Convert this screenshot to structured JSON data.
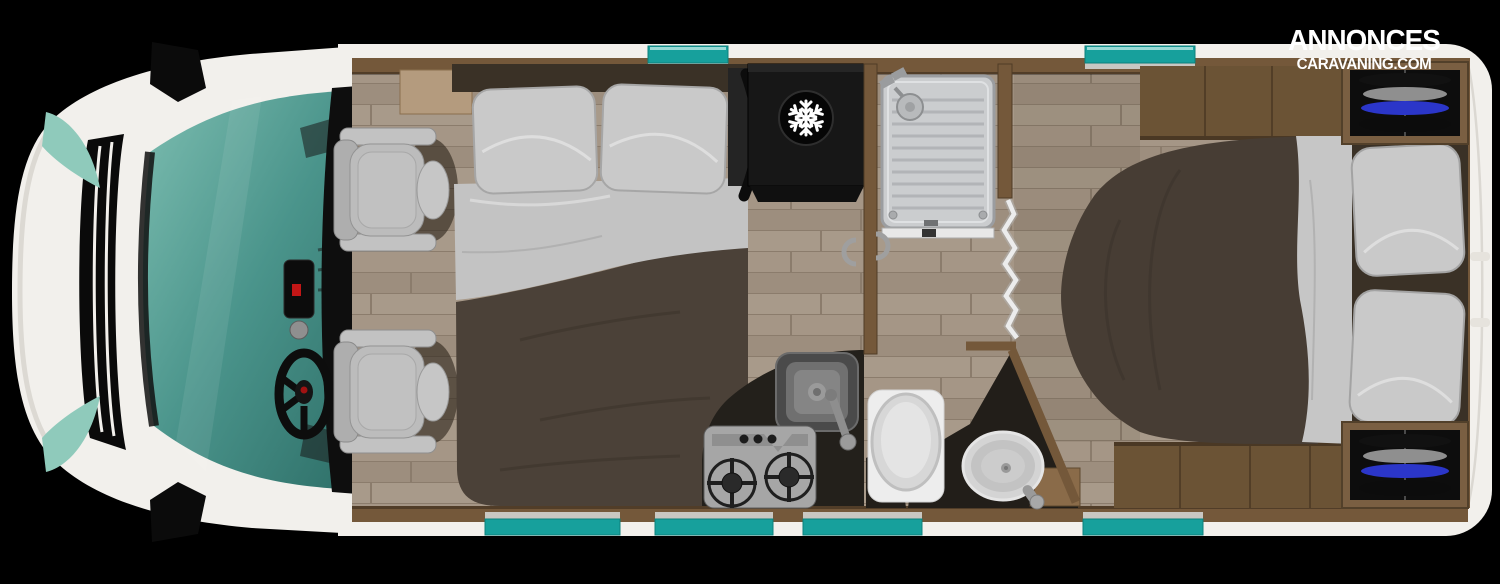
{
  "branding": {
    "line1": "ANNONCES",
    "line2": "CARAVANING.COM",
    "text_color": "#ffffff"
  },
  "colors": {
    "background": "#000000",
    "body_white": "#f2f0ec",
    "window_teal": "#17a09c",
    "window_teal_highlight": "#9adbd7",
    "windshield_teal": "#4a948b",
    "wall_brown": "#74583a",
    "platform_brown": "#6b5335",
    "wood_floor": "#a59686",
    "counter_black": "#23201b",
    "duvet_brown_front": "#4b4138",
    "duvet_brown_rear": "#473d34",
    "linen_gray": "#c6c6c6",
    "seat_gray": "#bcbcbc",
    "wardrobe_blue_garment": "#2b36c9",
    "fridge_black": "#171717"
  },
  "floorplan": {
    "vehicle_type": "motorhome (integral camper)",
    "view": "top-down floor plan",
    "orientation": "cab on left, rear bedroom on right",
    "zones": [
      "driver-cab with two swivel seats",
      "front french bed",
      "kitchen with sink and two-burner stove",
      "refrigerator",
      "shower cabin",
      "bathroom with toilet and washbasin",
      "rear island bed",
      "two rear wardrobes with hanging clothes"
    ],
    "fixtures": [
      "steering-wheel",
      "driver-seat",
      "passenger-seat",
      "front-bed",
      "tv-bracket",
      "refrigerator",
      "shower",
      "folding-door",
      "toilet",
      "washbasin",
      "kitchen-sink",
      "gas-stove",
      "rear-bed",
      "wardrobe-top",
      "wardrobe-bottom"
    ],
    "windows": {
      "top_count": 2,
      "bottom_count": 4
    },
    "icons": [
      "snowflake-icon"
    ]
  }
}
